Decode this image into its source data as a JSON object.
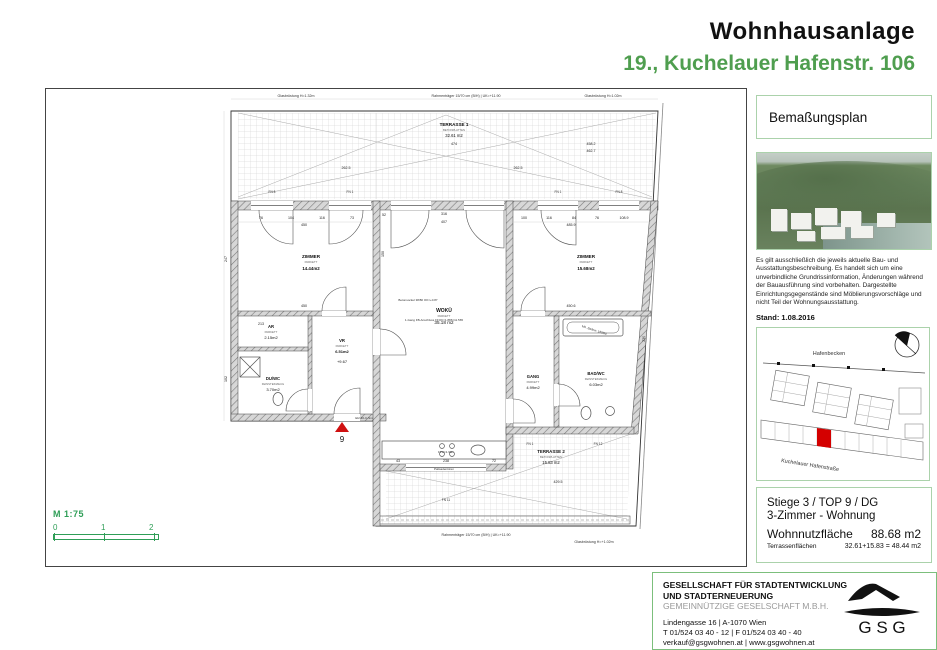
{
  "header": {
    "title": "Wohnhausanlage",
    "subtitle": "19., Kuchelauer Hafenstr. 106"
  },
  "plan": {
    "scale": {
      "label": "M 1:75",
      "ticks": [
        "0",
        "1",
        "2"
      ]
    },
    "entrance": {
      "number": "9",
      "door_label": "EI2 30-C-Sm"
    },
    "rooms": {
      "terrasse1": {
        "name": "TERRASSE 1",
        "floor": "BETONPLATTEN",
        "area": "32.61 m2"
      },
      "zimmer_l": {
        "name": "ZIMMER",
        "floor": "PARKETT",
        "area": "14.44m2"
      },
      "ar": {
        "name": "AR",
        "floor": "PARKETT",
        "area": "2.15m2"
      },
      "vr": {
        "name": "VR",
        "floor": "PARKETT",
        "area": "6.51m2",
        "level": "+9.67"
      },
      "duwc": {
        "name": "DU/WC",
        "floor": "FEINSTEINZEUG",
        "area": "3.70m2"
      },
      "woku": {
        "name": "WOKÜ",
        "floor": "PARKETT",
        "area": "35.18 m2"
      },
      "zimmer_r": {
        "name": "ZIMMER",
        "floor": "PARKETT",
        "area": "15.68m2"
      },
      "gang": {
        "name": "GANG",
        "floor": "PARKETT",
        "area": "4.99m2"
      },
      "bad": {
        "name": "BAD/WC",
        "floor": "FEINSTEINZEUG",
        "area": "6.03m2"
      },
      "terrasse2": {
        "name": "TERRASSE 2",
        "floor": "BETONPLATTEN",
        "area": "15.83 m2"
      }
    },
    "edge": {
      "top_left": "Glasbrüstung H=1.32m",
      "top_center": "Rahmenträger 15/70 cm (B/H) | UK=+11.90",
      "top_right": "Glasbrüstung H=1.02m",
      "bottom_center": "Rahmenträger 15/70 cm (B/H) | UK=+11.90",
      "bottom_right": "Glasbrüstung H=+1.02m"
    },
    "notes": {
      "sockel": "Betonsockel 38/80 OK=+0.87",
      "fb": "1-Gang FB-Anschluss FFOK=1.886=11.565",
      "palisaden": "Palisadentüren",
      "fph": "FPH=1.90m",
      "badew": "Mö. Badew. 180/80"
    },
    "windows": [
      "FN 8",
      "FN 1",
      "FN 1",
      "FN 8",
      "FN 1",
      "FN 12",
      "FN 11"
    ],
    "dims": [
      "76",
      "104",
      "116",
      "73",
      "450",
      "100",
      "116",
      "84",
      "76",
      "108.9",
      "485.9",
      "52",
      "316",
      "407",
      "262.5",
      "262.5",
      "474",
      "458.2",
      "462.7",
      "450",
      "450.6",
      "213",
      "429.5",
      "43",
      "238",
      "72",
      "247",
      "102",
      "335",
      "150"
    ]
  },
  "sidebar": {
    "plan_type": "Bemaßungsplan",
    "disclaimer": "Es gilt ausschließlich die jeweils aktuelle Bau- und Ausstattungsbeschreibung. Es handelt sich um eine unverbindliche Grundrissinformation, Änderungen während der Bauausführung sind vorbehalten. Dargestellte Einrichtungsgegenstände sind Möblierungsvorschläge und nicht Teil der Wohnungsausstattung.",
    "stand": "Stand:  1.08.2016",
    "siteplan": {
      "water_label": "Hafenbecken",
      "street_label": "Kuchelauer Hafenstraße"
    }
  },
  "unit_info": {
    "line1": "Stiege 3 / TOP 9 / DG",
    "line2": "3-Zimmer - Wohnung",
    "area_label": "Wohnnutzfläche",
    "area_value": "88.68 m2",
    "terrace_label": "Terrassenflächen",
    "terrace_value": "32.61+15.83 = 48.44 m2"
  },
  "footer": {
    "company_line1": "GESELLSCHAFT FÜR STADTENTWICKLUNG",
    "company_line2": "UND STADTERNEUERUNG",
    "company_line3": "GEMEINNÜTZIGE GESELSCHAFT M.B.H.",
    "address": "Lindengasse 16 | A-1070 Wien",
    "phone": "T 01/524 03 40 - 12 | F 01/524 03 40 - 40",
    "web": "verkauf@gsgwohnen.at | www.gsgwohnen.at",
    "logo_text": "G S G"
  },
  "colors": {
    "accent_green": "#4f9e4f",
    "box_border": "#abd2ab",
    "marker_red": "#cf1010"
  }
}
